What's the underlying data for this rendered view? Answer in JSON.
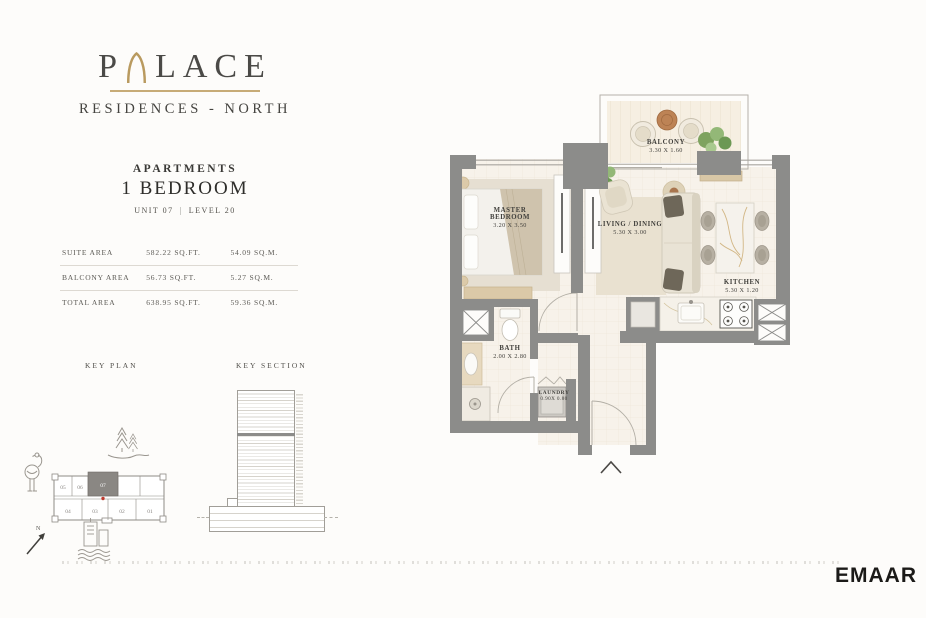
{
  "brand": {
    "wordmark_left": "P",
    "wordmark_right": "LACE",
    "subtitle": "RESIDENCES - NORTH",
    "accent_color": "#b99a5f"
  },
  "unit_info": {
    "category": "APARTMENTS",
    "type": "1 BEDROOM",
    "unit": "UNIT 07",
    "separator": "|",
    "level": "LEVEL 20"
  },
  "area_table": {
    "rows": [
      {
        "label": "SUITE AREA",
        "sqft": "582.22 SQ.FT.",
        "sqm": "54.09 SQ.M."
      },
      {
        "label": "BALCONY AREA",
        "sqft": "56.73 SQ.FT.",
        "sqm": "5.27 SQ.M."
      },
      {
        "label": "TOTAL AREA",
        "sqft": "638.95 SQ.FT.",
        "sqm": "59.36 SQ.M."
      }
    ]
  },
  "key_plan": {
    "title": "KEY PLAN",
    "north_label": "N",
    "highlighted_unit": "07",
    "units_top": [
      "05",
      "06",
      "07"
    ],
    "units_bottom": [
      "04",
      "03",
      "02",
      "01"
    ]
  },
  "key_section": {
    "title": "KEY SECTION"
  },
  "floor_plan": {
    "wall_color": "#8c8c8a",
    "floor_color": "#f7f2ea",
    "rooms": [
      {
        "name": "BALCONY",
        "dims": "3.30 X 1.60"
      },
      {
        "name": "MASTER BEDROOM",
        "dims": "3.20 X 3.50"
      },
      {
        "name": "LIVING / DINING",
        "dims": "5.30 X 3.00"
      },
      {
        "name": "KITCHEN",
        "dims": "5.30 X 1.20"
      },
      {
        "name": "BATH",
        "dims": "2.00 X 2.80"
      },
      {
        "name": "LAUNDRY",
        "dims": "0.90X 0.80"
      }
    ]
  },
  "footer": {
    "logo": "EMAAR"
  }
}
